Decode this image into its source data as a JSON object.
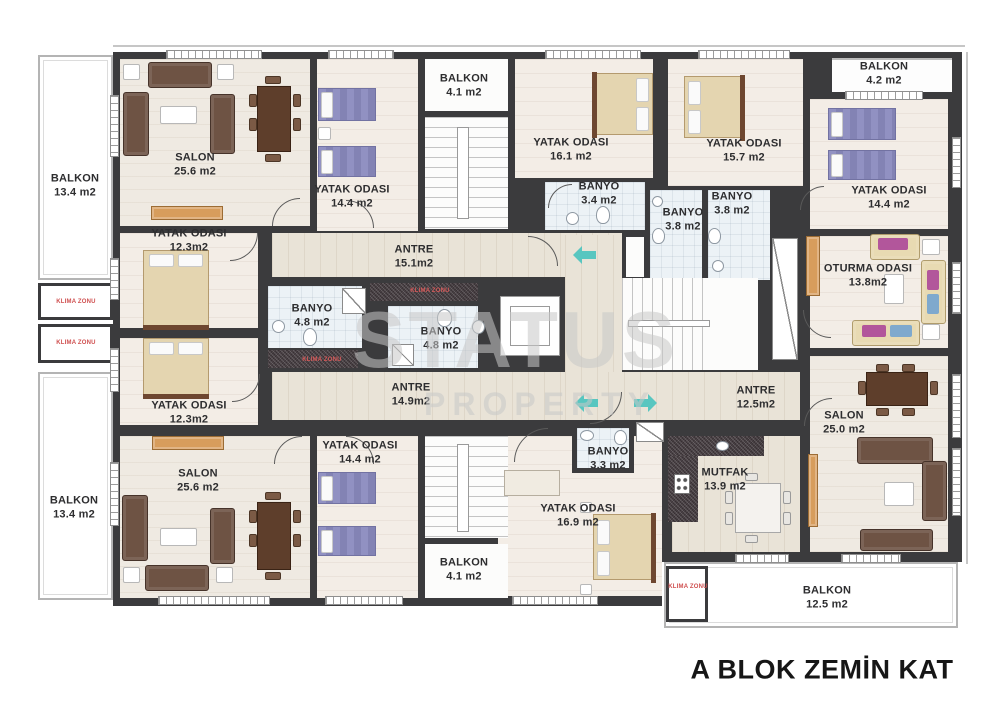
{
  "title": "A BLOK ZEMİN KAT",
  "watermark": {
    "line1": "STATUS",
    "line2": "PROPERTY"
  },
  "annotations": {
    "klima_zonu": "KLIMA ZONU"
  },
  "icons": {
    "direction-arrow-left": "css-teal-left-arrow",
    "direction-arrow-right": "css-teal-right-arrow"
  },
  "colors": {
    "wall": "#3b3b3d",
    "arrow_teal": "#58c6c0",
    "klima_red": "#cf4f4f",
    "watermark_gray": "#c8c8c8",
    "bath_floor": "#ecf2f6",
    "wood_floor": "#e9e3d7",
    "bedroom_floor": "#f3ede6",
    "salon_floor": "#efeae2",
    "dark_tile": "#4c4347",
    "bed_purple": "#8b8bbd",
    "bed_cream": "#e4d5b0",
    "sofa_brown": "#6e5344",
    "cabinet_orange": "#d79d5c"
  },
  "rooms": {
    "balkon_left_top": {
      "name": "BALKON",
      "area": "13.4 m2"
    },
    "salon_top_left": {
      "name": "SALON",
      "area": "25.6 m2"
    },
    "yatak_top_left": {
      "name": "YATAK ODASI",
      "area": "14.4 m2"
    },
    "balkon_top_mid": {
      "name": "BALKON",
      "area": "4.1 m2"
    },
    "yatak_16_1": {
      "name": "YATAK ODASI",
      "area": "16.1 m2"
    },
    "yatak_15_7": {
      "name": "YATAK ODASI",
      "area": "15.7 m2"
    },
    "balkon_top_right": {
      "name": "BALKON",
      "area": "4.2 m2"
    },
    "yatak_right": {
      "name": "YATAK ODASI",
      "area": "14.4 m2"
    },
    "oturma_odasi": {
      "name": "OTURMA ODASI",
      "area": "13.8m2"
    },
    "yatak_12_3_upper": {
      "name": "YATAK ODASI",
      "area": "12.3m2"
    },
    "antre_15_1": {
      "name": "ANTRE",
      "area": "15.1m2"
    },
    "banyo_4_8_a": {
      "name": "BANYO",
      "area": "4.8 m2"
    },
    "banyo_4_8_b": {
      "name": "BANYO",
      "area": "4.8 m2"
    },
    "banyo_3_4": {
      "name": "BANYO",
      "area": "3.4 m2"
    },
    "banyo_3_8_left": {
      "name": "BANYO",
      "area": "3.8 m2"
    },
    "banyo_3_8_right": {
      "name": "BANYO",
      "area": "3.8 m2"
    },
    "yatak_12_3_lower": {
      "name": "YATAK ODASI",
      "area": "12.3m2"
    },
    "antre_14_9": {
      "name": "ANTRE",
      "area": "14.9m2"
    },
    "antre_12_5": {
      "name": "ANTRE",
      "area": "12.5m2"
    },
    "salon_bottom_left": {
      "name": "SALON",
      "area": "25.6 m2"
    },
    "yatak_bottom_mid": {
      "name": "YATAK ODASI",
      "area": "14.4 m2"
    },
    "balkon_bottom_mid": {
      "name": "BALKON",
      "area": "4.1 m2"
    },
    "banyo_3_3": {
      "name": "BANYO",
      "area": "3.3 m2"
    },
    "mutfak": {
      "name": "MUTFAK",
      "area": "13.9 m2"
    },
    "yatak_16_9": {
      "name": "YATAK ODASI",
      "area": "16.9 m2"
    },
    "salon_right": {
      "name": "SALON",
      "area": "25.0 m2"
    },
    "balkon_left_bottom": {
      "name": "BALKON",
      "area": "13.4 m2"
    },
    "balkon_bottom_right": {
      "name": "BALKON",
      "area": "12.5 m2"
    }
  }
}
